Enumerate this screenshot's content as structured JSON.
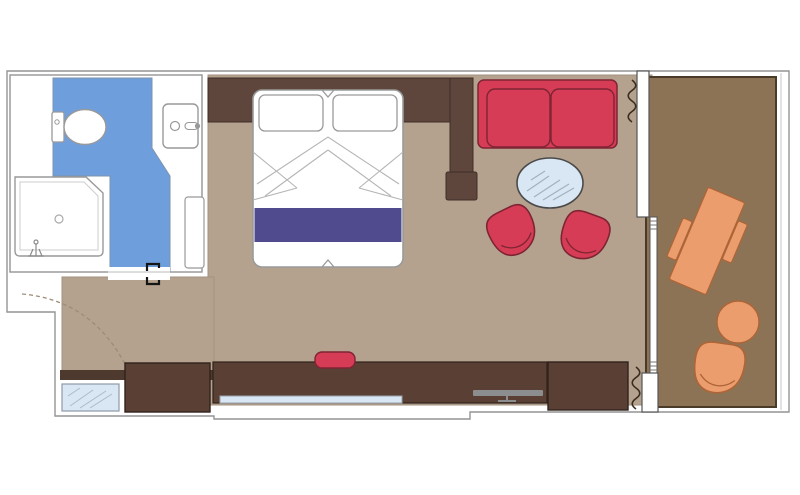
{
  "window": {
    "width": 800,
    "height": 495
  },
  "plan": {
    "type": "floor-plan",
    "description_visible_text": "",
    "rooms": [
      {
        "id": "bathroom",
        "features": [
          "toilet",
          "sink",
          "shower",
          "bathroom-floor",
          "bathroom-door-panel",
          "bathroom-door-marks"
        ]
      },
      {
        "id": "entry",
        "features": [
          "entry-door-swing",
          "closet-rail",
          "mirror"
        ]
      },
      {
        "id": "bedroom",
        "features": [
          "headboard-wall",
          "partition-wall",
          "double-bed",
          "pillow-left",
          "pillow-right",
          "bed-runner",
          "wardrobe",
          "desk-counter",
          "desk-glass-shelf",
          "stool",
          "tv",
          "cabinet"
        ]
      },
      {
        "id": "sitting-area",
        "features": [
          "sofa",
          "coffee-table",
          "armchair-left",
          "armchair-right",
          "curtain-top",
          "curtain-bottom",
          "window-wall",
          "balcony-door"
        ]
      },
      {
        "id": "balcony",
        "features": [
          "balcony-floor",
          "balcony-table",
          "balcony-bench-left",
          "balcony-bench-right",
          "balcony-round-table",
          "balcony-armchair"
        ]
      }
    ]
  },
  "colors": {
    "room_floor": "#b4a28f",
    "bathroom_floor": "#6f9edd",
    "balcony_floor": "#8d7355",
    "balcony_border": "#4a3b29",
    "wood_dark": "#5a4034",
    "wall_wood": "#5e463d",
    "closet_rail": "#4e392e",
    "red": "#d63c55",
    "red_outline": "#7e2433",
    "orange": "#ec9d6d",
    "orange_outline": "#ad6537",
    "purple": "#4f4b8e",
    "glass": "#d9e6f3",
    "outline_gray": "#949494",
    "tv_gray": "#8b8d8e",
    "curtain": "#3c2c1e"
  }
}
